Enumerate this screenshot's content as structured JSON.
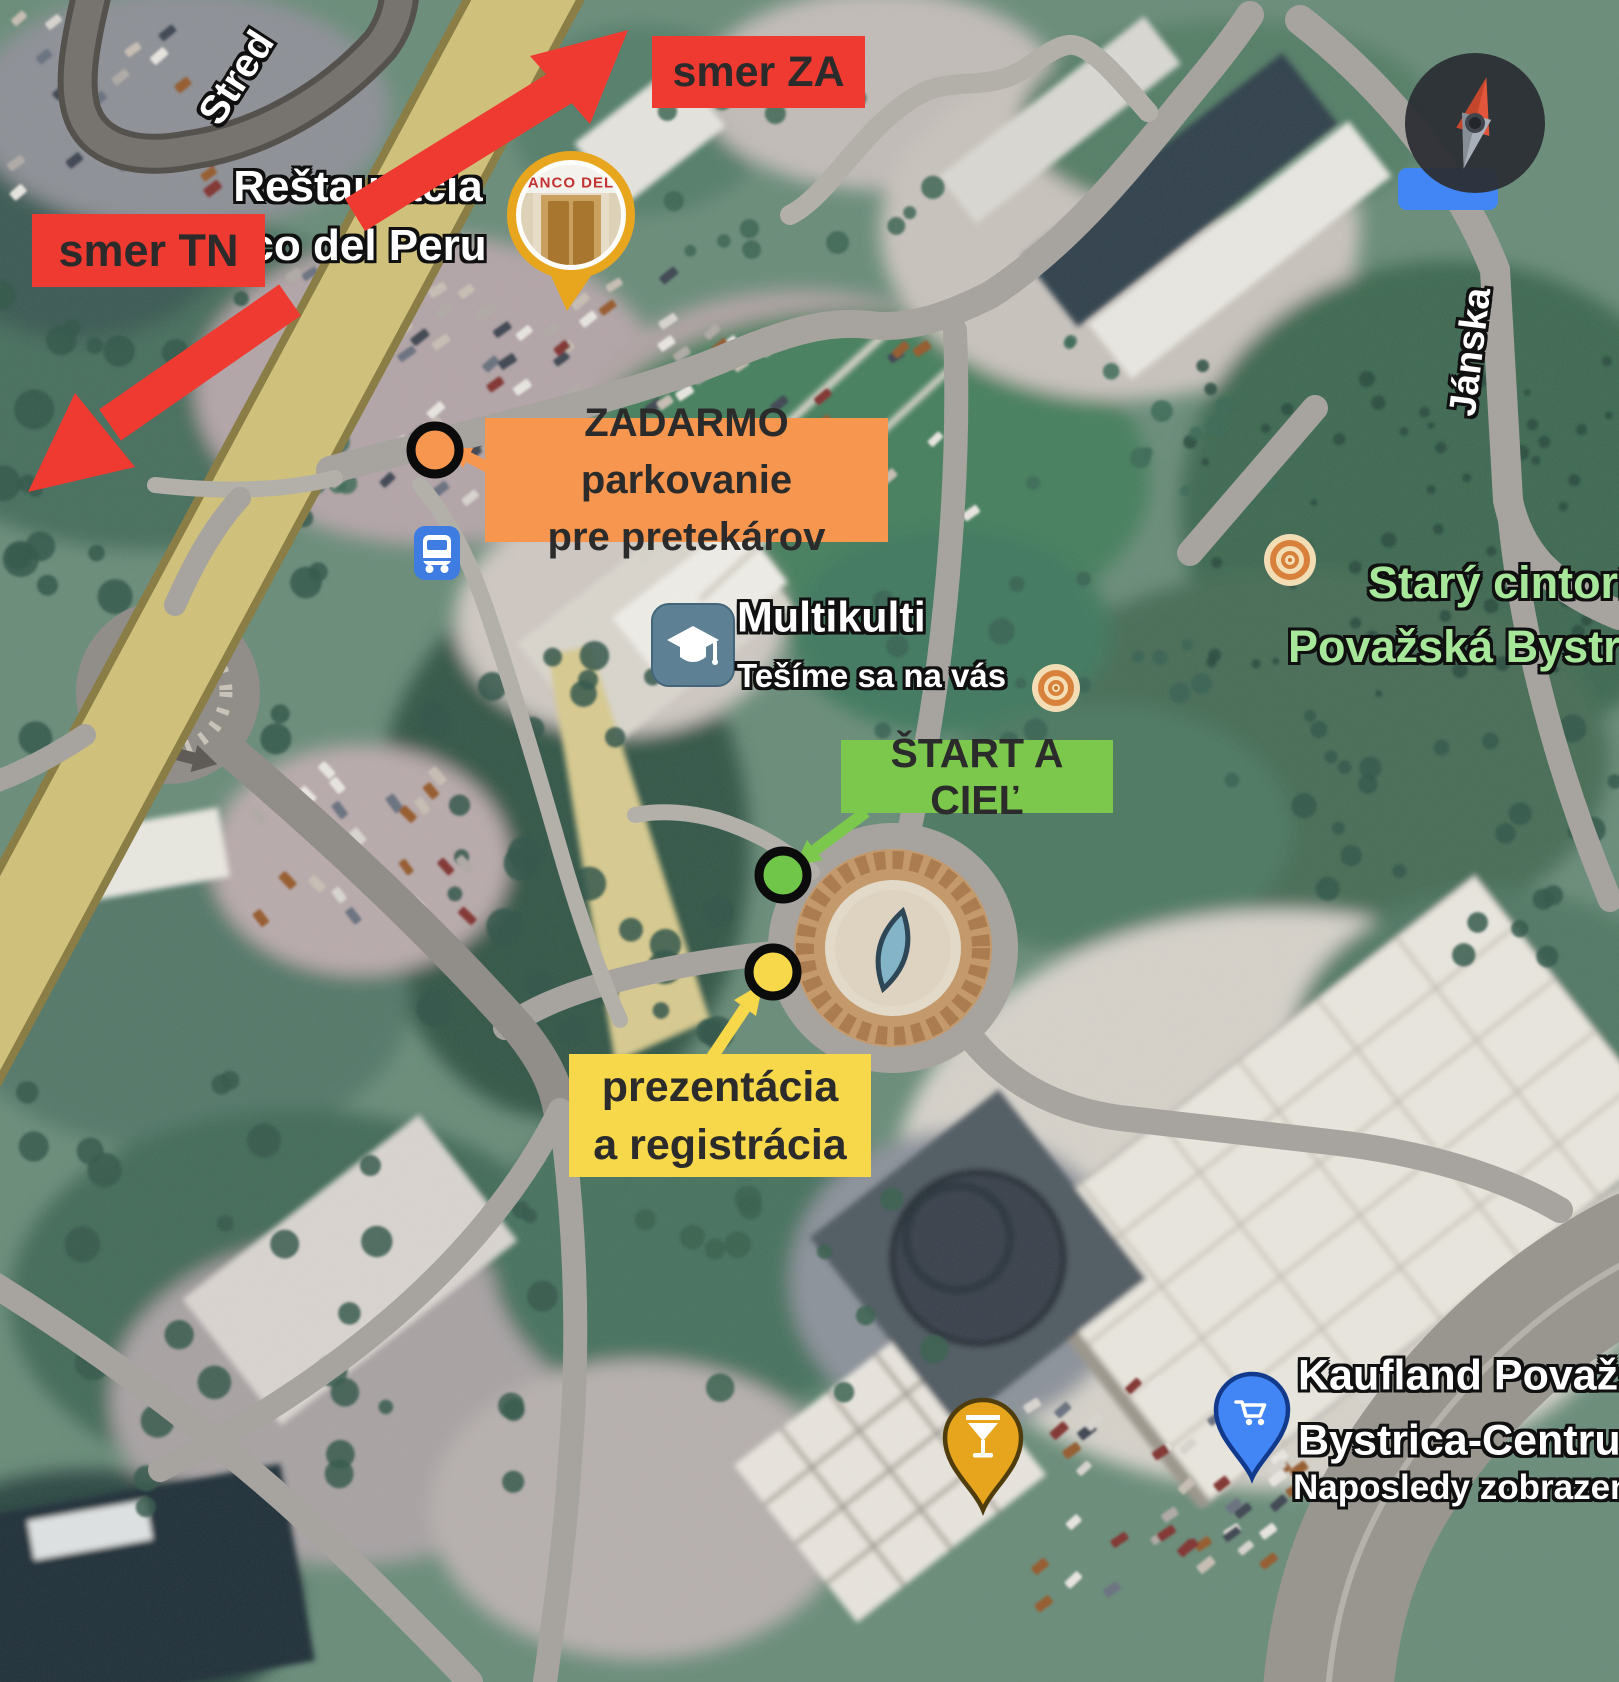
{
  "annotations": {
    "direction_za": {
      "label": "smer ZA"
    },
    "direction_tn": {
      "label": "smer TN"
    },
    "free_parking": {
      "line1": "ZADARMO parkovanie",
      "line2": "pre pretekárov"
    },
    "start_finish": {
      "label": "ŠTART A CIEĽ"
    },
    "registration": {
      "line1": "prezentácia",
      "line2": "a registrácia"
    }
  },
  "map_labels": {
    "street_top_left": "Stred",
    "street_right": "Jánska",
    "restaurant_line1": "Reštaurácia",
    "restaurant_line2": "co del Peru",
    "restaurant_sign": "ANCO DEL",
    "multikulti_title": "Multikulti",
    "multikulti_subtitle": "Tešíme sa na vás",
    "cemetery_line1": "Starý cintorín",
    "cemetery_line2": "Považská Bystrica",
    "kaufland_line1": "Kaufland Považská",
    "kaufland_line2": "Bystrica-Centrum",
    "kaufland_line3": "Naposledy zobrazené"
  },
  "icons": {
    "bus_stop": "bus-icon",
    "education": "graduation-cap-icon",
    "bar_pin": "cocktail-pin-icon",
    "grocery_pin": "shopping-cart-pin-icon",
    "compass": "compass-icon",
    "restaurant_marker": "photo-marker-icon"
  },
  "colors": {
    "annotation_red": "#ee3a31",
    "annotation_orange": "#f6964f",
    "annotation_green": "#7cc84c",
    "annotation_yellow": "#f7d84a",
    "map_label_green": "#a6e79a",
    "main_road_tan": "#cfc07b",
    "pin_blue": "#4285f4",
    "pin_amber": "#e7a41d"
  }
}
